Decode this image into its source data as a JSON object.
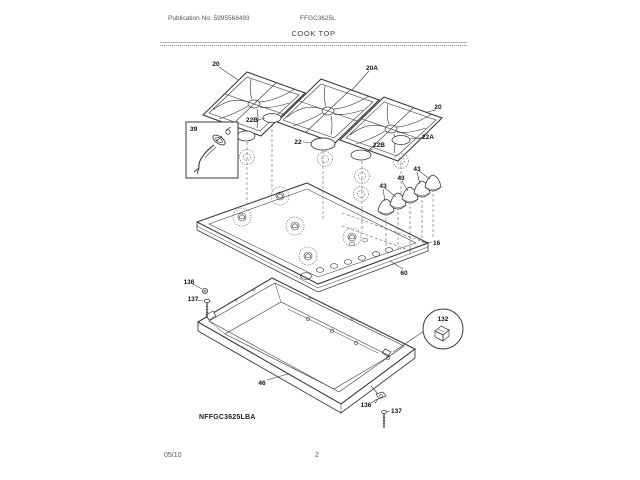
{
  "header": {
    "publication": "Publication No: 5995568493",
    "model": "FFGC3625L",
    "title": "COOK TOP"
  },
  "footer": {
    "date": "05/10",
    "page": "2"
  },
  "diagram": {
    "drawing_code": "NFFGC3625LBA",
    "callouts": {
      "grate_left": "20",
      "grate_middle": "20A",
      "grate_right": "20",
      "cap_left": "22B",
      "cap_center": "22",
      "cap_mid_right": "22B",
      "cap_right": "22A",
      "igniter": "39",
      "head_a": "43",
      "head_b": "43",
      "head_c": "43",
      "main_top": "16",
      "top_trim": "60",
      "screw_left_a": "136",
      "screw_left_b": "137",
      "burner_box": "46",
      "bracket_detail": "132",
      "screw_right_a": "136",
      "screw_right_b": "137"
    }
  }
}
